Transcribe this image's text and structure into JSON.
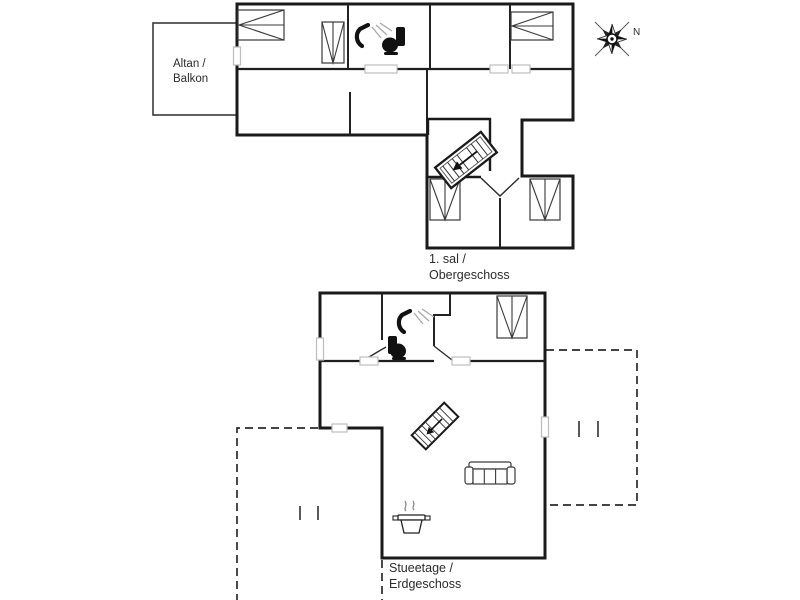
{
  "page": {
    "background": "#ffffff",
    "width": 800,
    "height": 600
  },
  "plan": {
    "type": "two-storey-floor-plan",
    "compass": {
      "north_label": "N"
    },
    "upper_floor": {
      "label_line1": "1. sal /",
      "label_line2": "Obergeschoss",
      "balcony": {
        "label_line1": "Altan /",
        "label_line2": "Balkon"
      },
      "furniture": [
        "double-bed",
        "double-bed",
        "wardrobe",
        "wardrobe",
        "wardrobe",
        "shower",
        "toilet",
        "staircase"
      ]
    },
    "ground_floor": {
      "label_line1": "Stueetage /",
      "label_line2": "Erdgeschoss",
      "furniture": [
        "wardrobe",
        "shower",
        "toilet",
        "staircase",
        "sofa",
        "cooking-pot"
      ],
      "terrace_count": 2
    },
    "colors": {
      "wall": "#1a1a1a",
      "window_mark": "#bdbdbd",
      "dashed_outline": "#2a2a2a",
      "furniture": "#3a3a3a",
      "text": "#2b2b2b",
      "background": "#ffffff"
    }
  }
}
